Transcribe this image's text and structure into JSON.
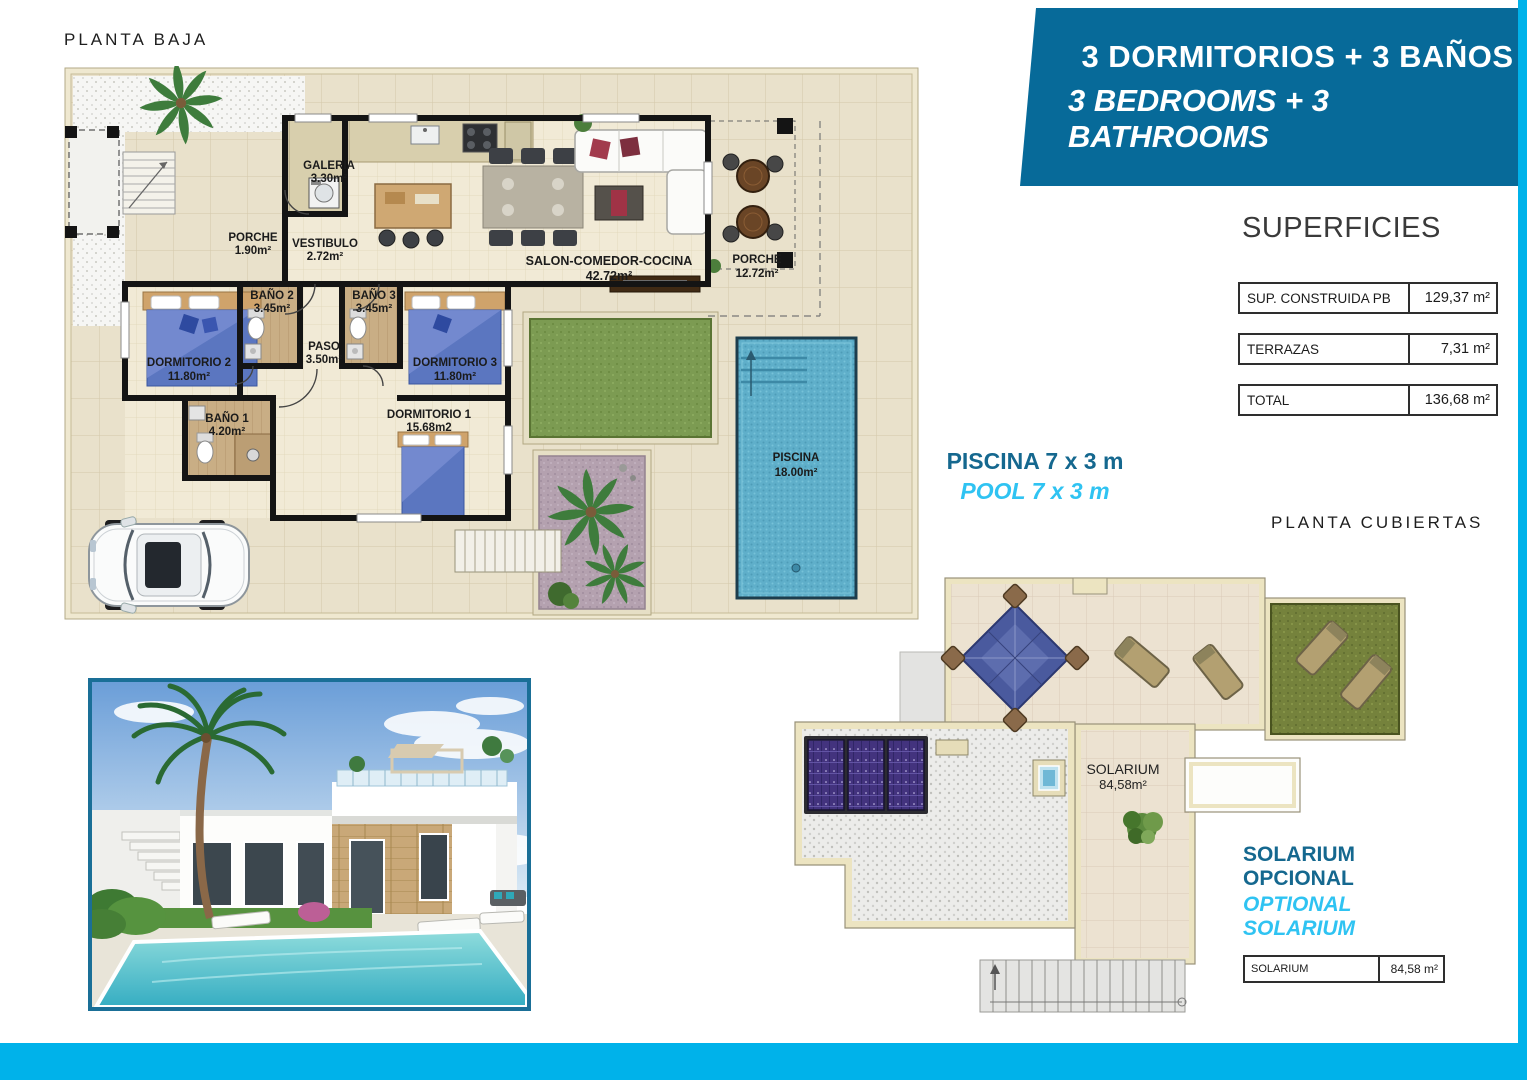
{
  "colors": {
    "accent_cyan": "#00b2ea",
    "banner_blue": "#076a99",
    "teal_text": "#15688f",
    "cyan_text": "#2fc3f2"
  },
  "banner": {
    "line1": "3 DORMITORIOS + 3 BAÑOS",
    "line2": "3 BEDROOMS + 3 BATHROOMS"
  },
  "ground_floor": {
    "title": "PLANTA BAJA",
    "rooms": {
      "galeria": {
        "name": "GALERIA",
        "area": "3.30m²"
      },
      "porche_entrada": {
        "name": "PORCHE",
        "area": "1.90m²"
      },
      "vestibulo": {
        "name": "VESTIBULO",
        "area": "2.72m²"
      },
      "salon": {
        "name": "SALON-COMEDOR-COCINA",
        "area": "42.72m²"
      },
      "porche": {
        "name": "PORCHE",
        "area": "12.72m²"
      },
      "dormitorio2": {
        "name": "DORMITORIO 2",
        "area": "11.80m²"
      },
      "bano2": {
        "name": "BAÑO 2",
        "area": "3.45m²"
      },
      "bano3": {
        "name": "BAÑO 3",
        "area": "3.45m²"
      },
      "paso": {
        "name": "PASO",
        "area": "3.50m²"
      },
      "dormitorio3": {
        "name": "DORMITORIO 3",
        "area": "11.80m²"
      },
      "bano1": {
        "name": "BAÑO 1",
        "area": "4.20m²"
      },
      "dormitorio1": {
        "name": "DORMITORIO 1",
        "area": "15.68m2"
      },
      "piscina": {
        "name": "PISCINA",
        "area": "18.00m²"
      }
    }
  },
  "superficies": {
    "title": "SUPERFICIES",
    "rows": [
      {
        "label": "SUP. CONSTRUIDA PB",
        "value": "129,37 m²"
      },
      {
        "label": "TERRAZAS",
        "value": "7,31 m²"
      },
      {
        "label": "TOTAL",
        "value": "136,68 m²"
      }
    ]
  },
  "pool_note": {
    "es": "PISCINA 7 x 3 m",
    "en": "POOL 7 x 3 m"
  },
  "roof_plan": {
    "title": "PLANTA CUBIERTAS",
    "solarium": {
      "name": "SOLARIUM",
      "area": "84,58m²"
    }
  },
  "solarium_note": {
    "es": "SOLARIUM OPCIONAL",
    "en": "OPTIONAL SOLARIUM",
    "table": {
      "label": "SOLARIUM",
      "value": "84,58 m²"
    }
  }
}
